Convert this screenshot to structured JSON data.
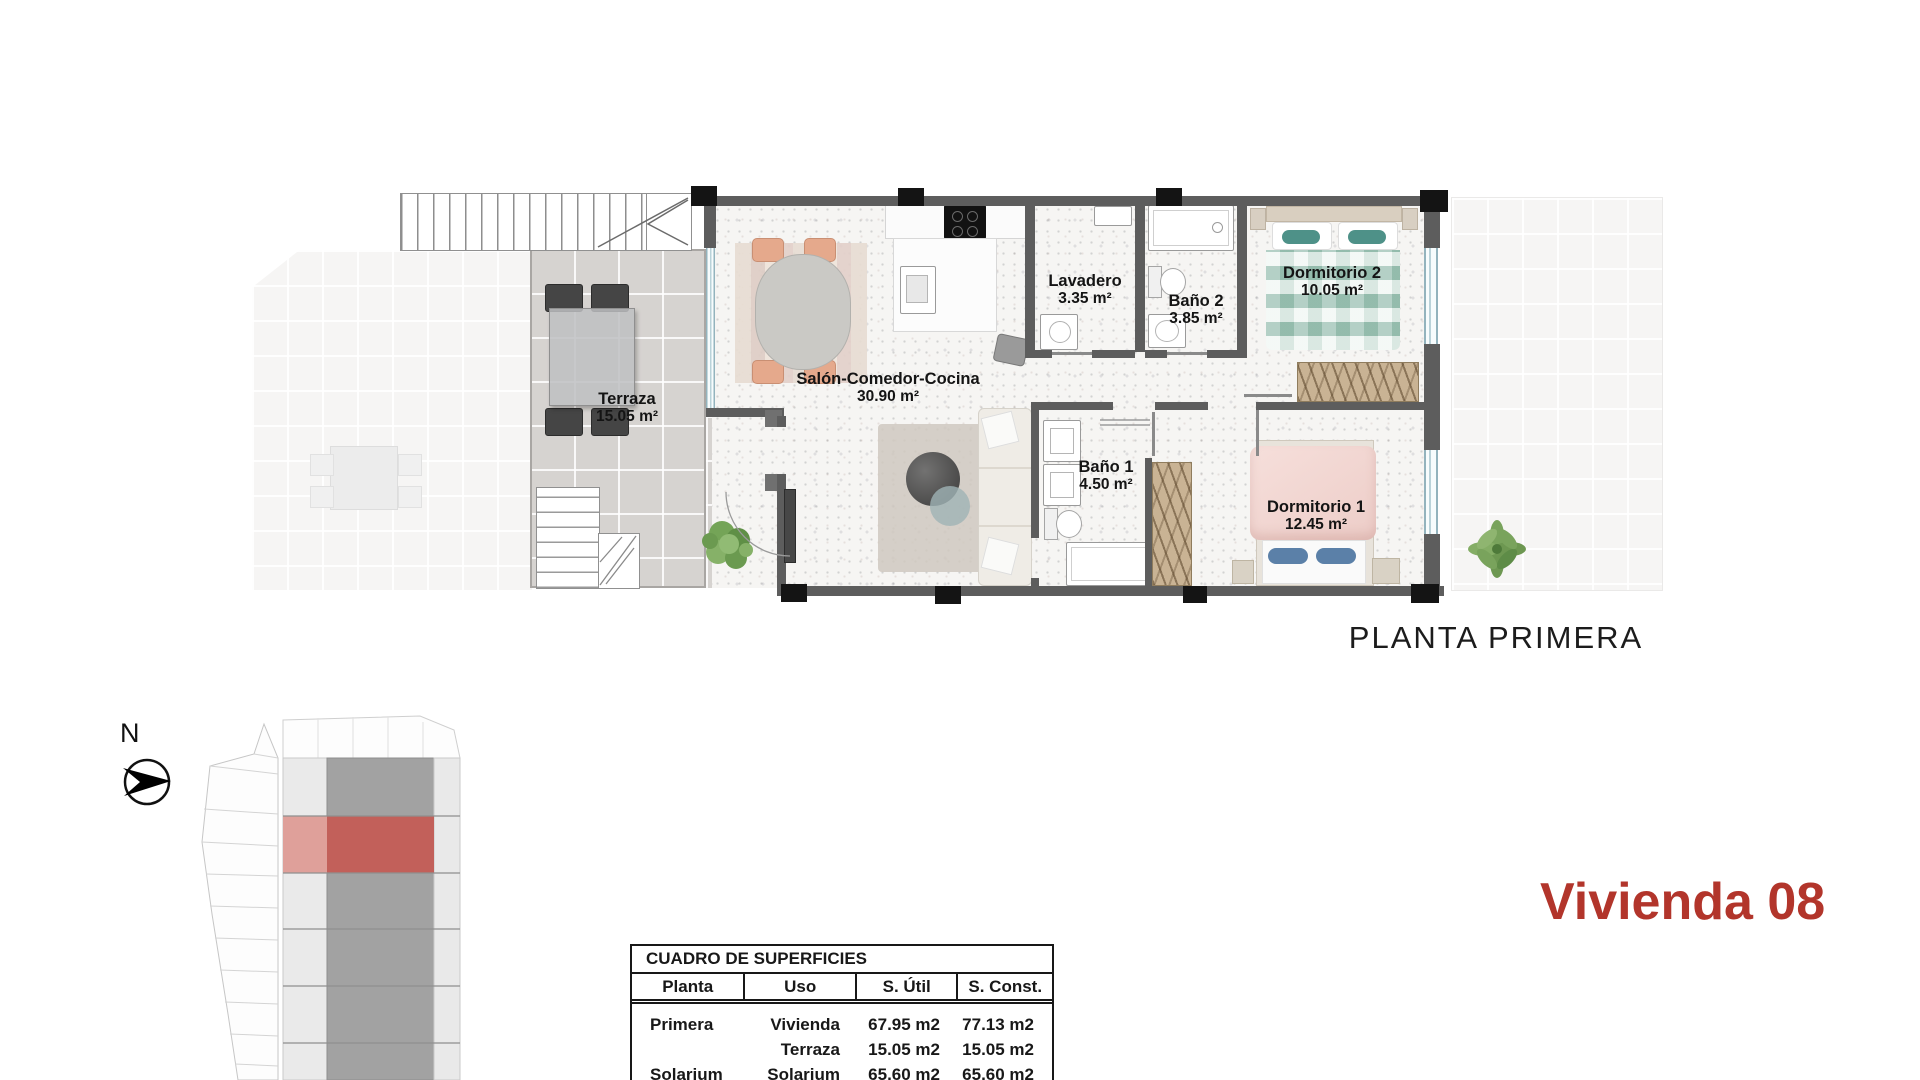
{
  "plan": {
    "title": "PLANTA PRIMERA"
  },
  "unit": {
    "title": "Vivienda 08",
    "accent_color": "#b2352b"
  },
  "compass": {
    "label": "N"
  },
  "rooms": [
    {
      "id": "terraza",
      "name": "Terraza",
      "area": "15.05 m²"
    },
    {
      "id": "salon",
      "name": "Salón-Comedor-Cocina",
      "area": "30.90 m²"
    },
    {
      "id": "lavadero",
      "name": "Lavadero",
      "area": "3.35 m²"
    },
    {
      "id": "bano2",
      "name": "Baño 2",
      "area": "3.85 m²"
    },
    {
      "id": "dormitorio2",
      "name": "Dormitorio 2",
      "area": "10.05 m²"
    },
    {
      "id": "bano1",
      "name": "Baño 1",
      "area": "4.50 m²"
    },
    {
      "id": "dormitorio1",
      "name": "Dormitorio 1",
      "area": "12.45 m²"
    }
  ],
  "surfaces_table": {
    "title": "CUADRO DE SUPERFICIES",
    "headers": [
      "Planta",
      "Uso",
      "S. Útil",
      "S. Const."
    ],
    "rows": [
      {
        "planta": "Primera",
        "uso": "Vivienda",
        "s_util": "67.95 m2",
        "s_const": "77.13 m2"
      },
      {
        "planta": "",
        "uso": "Terraza",
        "s_util": "15.05 m2",
        "s_const": "15.05 m2"
      },
      {
        "planta": "Solarium",
        "uso": "Solarium",
        "s_util": "65.60 m2",
        "s_const": "65.60 m2"
      }
    ]
  },
  "site_plan": {
    "highlight_color": "#c2605a"
  }
}
